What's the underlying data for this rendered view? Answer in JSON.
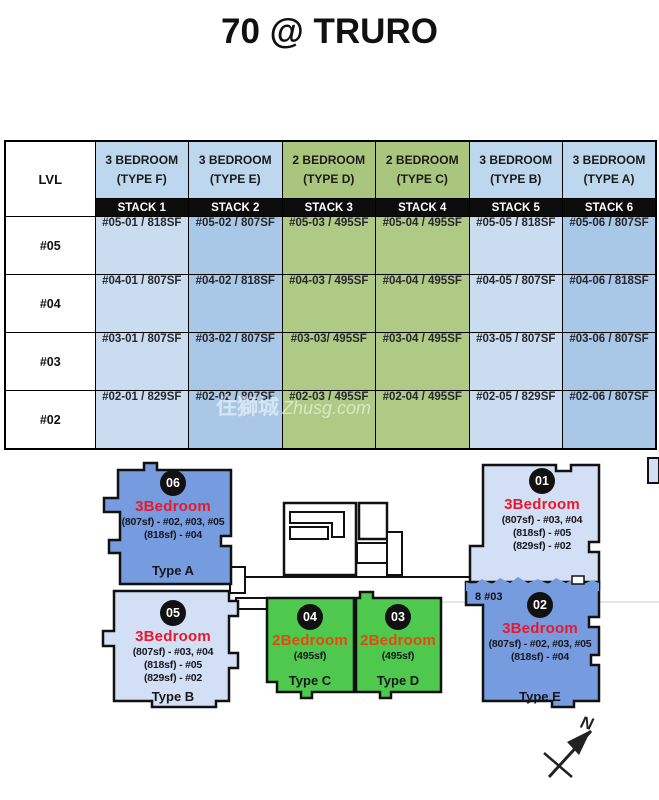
{
  "title": "70 @ TRURO",
  "watermark": {
    "cjk": "住獅城",
    "latin": "Zhusg.com"
  },
  "stack_table": {
    "level_header": "LVL",
    "columns": [
      {
        "type": "3 BEDROOM",
        "type_label": "(TYPE F)",
        "stack": "STACK 1",
        "header_color": "#bdd7ee",
        "cell_color": "#cadcf0"
      },
      {
        "type": "3 BEDROOM",
        "type_label": "(TYPE E)",
        "stack": "STACK 2",
        "header_color": "#bdd7ee",
        "cell_color": "#a9c7e6"
      },
      {
        "type": "2 BEDROOM",
        "type_label": "(TYPE D)",
        "stack": "STACK 3",
        "header_color": "#aac67e",
        "cell_color": "#aeca84"
      },
      {
        "type": "2 BEDROOM",
        "type_label": "(TYPE C)",
        "stack": "STACK 4",
        "header_color": "#aac67e",
        "cell_color": "#aeca84"
      },
      {
        "type": "3 BEDROOM",
        "type_label": "(TYPE B)",
        "stack": "STACK 5",
        "header_color": "#bdd7ee",
        "cell_color": "#cadcf0"
      },
      {
        "type": "3 BEDROOM",
        "type_label": "(TYPE A)",
        "stack": "STACK 6",
        "header_color": "#bdd7ee",
        "cell_color": "#a9c7e6"
      }
    ],
    "rows": [
      {
        "level": "#05",
        "units": [
          "#05-01 / 818SF",
          "#05-02 / 807SF",
          "#05-03 / 495SF",
          "#05-04 / 495SF",
          "#05-05 / 818SF",
          "#05-06 / 807SF"
        ]
      },
      {
        "level": "#04",
        "units": [
          "#04-01 / 807SF",
          "#04-02 / 818SF",
          "#04-03 / 495SF",
          "#04-04 / 495SF",
          "#04-05 / 807SF",
          "#04-06 / 818SF"
        ]
      },
      {
        "level": "#03",
        "units": [
          "#03-01 / 807SF",
          "#03-02 / 807SF",
          "#03-03/ 495SF",
          "#03-04 / 495SF",
          "#03-05 / 807SF",
          "#03-06 / 807SF"
        ]
      },
      {
        "level": "#02",
        "units": [
          "#02-01 / 829SF",
          "#02-02 / 807SF",
          "#02-03 / 495SF",
          "#02-04 / 495SF",
          "#02-05 / 829SF",
          "#02-06 / 807SF"
        ]
      }
    ]
  },
  "site_plan": {
    "blocks": [
      {
        "number": "06",
        "category": "3Bedroom",
        "sizes": [
          "(807sf) - #02, #03, #05",
          "(818sf) - #04"
        ],
        "type_label": "Type A",
        "fill": "#769bde"
      },
      {
        "number": "05",
        "category": "3Bedroom",
        "sizes": [
          "(807sf) - #03, #04",
          "(818sf) - #05",
          "(829sf) - #02"
        ],
        "type_label": "Type B",
        "fill": "#d3dff4"
      },
      {
        "number": "04",
        "category": "2Bedroom",
        "sizes": [
          "(495sf)"
        ],
        "type_label": "Type C",
        "fill": "#4ec94e"
      },
      {
        "number": "03",
        "category": "2Bedroom",
        "sizes": [
          "(495sf)"
        ],
        "type_label": "Type D",
        "fill": "#4ec94e"
      },
      {
        "number": "01",
        "category": "3Bedroom",
        "sizes": [
          "(807sf) - #03, #04",
          "(818sf) - #05",
          "(829sf) - #02"
        ],
        "type_label": "",
        "fill": "#d3dff4"
      },
      {
        "number": "02",
        "category": "3Bedroom",
        "sizes": [
          "(807sf) - #02, #03, #05",
          "(818sf) - #04"
        ],
        "type_label": "Type E",
        "fill": "#769bde"
      }
    ],
    "tear_text": "8 #03",
    "compass_label": "N"
  },
  "colors": {
    "three_bed_text": "#e8192d",
    "two_bed_text": "#e8470e",
    "stack_bar_bg": "#0c0c0c",
    "table_blue_header": "#bdd7ee",
    "table_green_header": "#aac67e",
    "block_blue_dark": "#769bde",
    "block_blue_light": "#d3dff4",
    "block_green": "#4ec94e"
  }
}
